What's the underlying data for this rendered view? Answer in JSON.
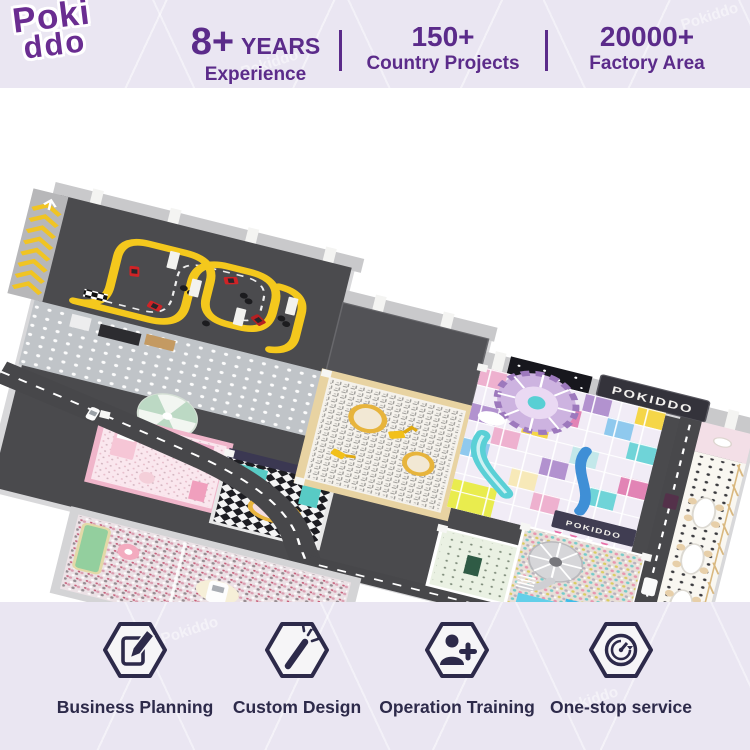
{
  "header": {
    "logo": {
      "line1": "Poki",
      "line2": "ddo"
    },
    "stats": [
      {
        "value": "8+",
        "unit": "YEARS",
        "label": "Experience"
      },
      {
        "value": "150+",
        "label": "Country Projects"
      },
      {
        "value": "20000+",
        "label": "Factory Area"
      }
    ]
  },
  "scene": {
    "sign_text": "POKIDDO",
    "watermark": "Pokiddo"
  },
  "footer": {
    "services": [
      {
        "icon": "notepad-pencil-icon",
        "label": "Business Planning"
      },
      {
        "icon": "magic-wand-icon",
        "label": "Custom Design"
      },
      {
        "icon": "person-plus-icon",
        "label": "Operation Training"
      },
      {
        "icon": "circular-arrows-icon",
        "label": "One-stop service"
      }
    ]
  },
  "colors": {
    "accent_purple": "#5b2b8a",
    "icon_navy": "#2d2a4a",
    "lavender_bg": "#eae6f2",
    "track_yellow": "#f2c41d",
    "asphalt": "#4a4a4d"
  }
}
